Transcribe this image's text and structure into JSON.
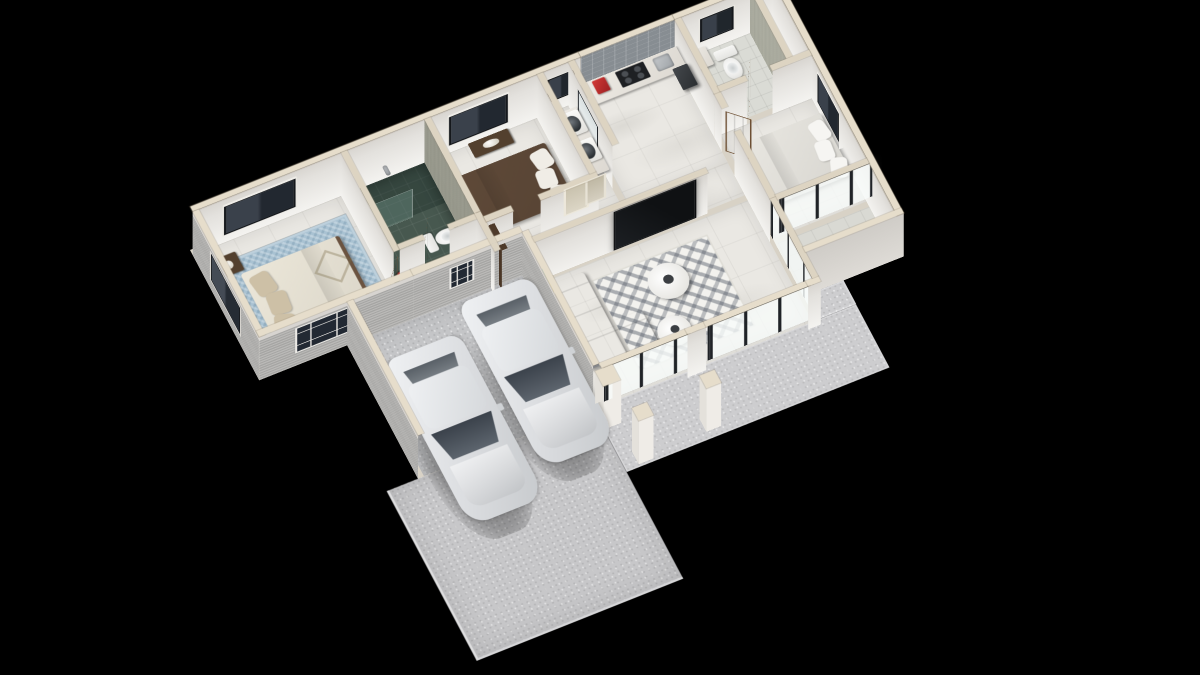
{
  "meta": {
    "title": "3D isometric floor plan render",
    "background": "#000000",
    "view": "axonometric dollhouse cutaway, single-storey house with carport and two cars"
  },
  "palette": {
    "wall_cap": "#e6ddcb",
    "wall_interior": "#f0eeea",
    "wall_exterior": "#b2b1af",
    "floor_marble": "#eae8e3",
    "bath_teal": "#47584f",
    "rug_blue": "#a9c2d2",
    "rug_pattern": "#f3f2ee",
    "sofa_grey": "#9c9ea1",
    "bed_brown": "#5e4938",
    "wood_door": "#97714c",
    "glass_frame": "#202327",
    "car_white": "#e6e8ea",
    "concrete": "#c6c6c8",
    "accent_red": "#c0282a",
    "art_teal": "#35a3ad",
    "art_sand": "#e3c765"
  },
  "scene": {
    "pxm": 56,
    "wallH": 106,
    "doorH": 98,
    "camera": {
      "originX": 190,
      "originY": 250,
      "scale": 0.82,
      "tiltDeg": 30,
      "spinDeg": -24.7
    },
    "base": [
      {
        "n": "house-base-back",
        "r": [
          0,
          0,
          14.05,
          3.6
        ]
      },
      {
        "n": "house-base-mid",
        "r": [
          2.1,
          3.6,
          9.6,
          3.85
        ]
      },
      {
        "n": "house-base-wing",
        "r": [
          11.55,
          2.05,
          2.5,
          4.6
        ]
      }
    ],
    "floors": [
      {
        "n": "bedroom1-floor",
        "s": "marble",
        "r": [
          0.15,
          0.15,
          3.4,
          3.3
        ]
      },
      {
        "n": "bedroom1-blue-rug",
        "s": "bluerug",
        "r": [
          0.5,
          0.6,
          2.95,
          2.55
        ],
        "z": 1.2
      },
      {
        "n": "bath1-floor",
        "s": "teal",
        "r": [
          3.7,
          0.15,
          1.85,
          2.6
        ]
      },
      {
        "n": "bath1-shower-zone",
        "s": "tealdark",
        "r": [
          3.7,
          0.15,
          1.85,
          1.1
        ],
        "z": 0.9
      },
      {
        "n": "hall-nook-floor",
        "s": "marble",
        "r": [
          3.7,
          2.9,
          1.85,
          0.9
        ]
      },
      {
        "n": "bedroom2-floor",
        "s": "marble",
        "r": [
          5.7,
          0.15,
          2.55,
          2.75
        ]
      },
      {
        "n": "laundry-floor",
        "s": "marble",
        "r": [
          8.4,
          0.15,
          0.6,
          2.75
        ]
      },
      {
        "n": "kitchen-floor",
        "s": "marble",
        "r": [
          9.15,
          0.15,
          2.4,
          2.75
        ]
      },
      {
        "n": "bath2-floor",
        "s": "tilelight",
        "r": [
          11.7,
          0.15,
          1.65,
          1.9
        ]
      },
      {
        "n": "closet-floor",
        "s": "marble",
        "r": [
          13.5,
          0.15,
          0.4,
          1.9
        ]
      },
      {
        "n": "corridor-floor-a",
        "s": "marble",
        "r": [
          5.7,
          2.9,
          0.6,
          0.55
        ]
      },
      {
        "n": "corridor-floor-b",
        "s": "marble",
        "r": [
          6.3,
          2.9,
          5.25,
          0.9
        ]
      },
      {
        "n": "bedroom3-floor",
        "s": "marble",
        "r": [
          11.7,
          2.2,
          2.2,
          2.85
        ]
      },
      {
        "n": "terrace-floor",
        "s": "terrazzo",
        "r": [
          11.7,
          5.2,
          2.2,
          1.3
        ]
      },
      {
        "n": "living-room-floor",
        "s": "marble",
        "r": [
          6.45,
          3.95,
          5.1,
          3.35
        ]
      },
      {
        "n": "living-triangle-rug",
        "s": "rugtri",
        "r": [
          7.6,
          4.35,
          2.8,
          2.55
        ],
        "z": 1.2
      },
      {
        "n": "garage-floor",
        "s": "concrete",
        "r": [
          2.25,
          3.6,
          4.05,
          3.7
        ]
      },
      {
        "n": "porch-slab",
        "s": "porch",
        "r": [
          6.3,
          7.3,
          6.3,
          1.75
        ],
        "z": 0.4
      },
      {
        "n": "porch-slab-2",
        "s": "porch",
        "r": [
          11.7,
          6.65,
          0.9,
          0.65
        ],
        "z": 0.4
      },
      {
        "n": "driveway-slab",
        "s": "drive",
        "r": [
          1.35,
          7.3,
          4.95,
          4.7
        ],
        "z": 0.3
      }
    ],
    "walls": [
      {
        "n": "back-wall-left",
        "d": "h",
        "x": 0,
        "y": 0,
        "len": 9.3,
        "th": 0.15,
        "cap": "ext",
        "face": "intwhite",
        "win": [
          {
            "t": "dark2",
            "off": 0.75,
            "w": 1.6
          },
          {
            "t": "dark2",
            "off": 6.15,
            "w": 1.3
          },
          {
            "t": "small2",
            "off": 8.5,
            "w": 0.55
          }
        ]
      },
      {
        "n": "back-wall-kitchen-tile",
        "d": "h",
        "x": 9.3,
        "y": 0,
        "len": 2.25,
        "th": 0.15,
        "cap": "ext",
        "face": "tile"
      },
      {
        "n": "back-wall-right",
        "d": "h",
        "x": 11.55,
        "y": 0,
        "len": 2.5,
        "th": 0.15,
        "cap": "ext",
        "face": "intwhite",
        "win": [
          {
            "t": "small2",
            "off": 0.6,
            "w": 0.7
          }
        ]
      },
      {
        "n": "left-gable-wall",
        "d": "v",
        "x": 0,
        "y": 0.15,
        "len": 3.45,
        "th": 0.15,
        "cap": "ext",
        "face": "extgrey",
        "win": [
          {
            "t": "extdark",
            "off": 0.95,
            "w": 1.4
          }
        ]
      },
      {
        "n": "front-wall-bedroom1",
        "d": "h",
        "x": 0,
        "y": 3.45,
        "len": 3.7,
        "th": 0.15,
        "cap": "ext",
        "face": "extgrey",
        "win": [
          {
            "t": "white4",
            "off": 0.85,
            "w": 1.25
          }
        ]
      },
      {
        "n": "garage-back-wall",
        "d": "h",
        "x": 3.7,
        "y": 3.45,
        "len": 2.6,
        "th": 0.15,
        "cap": "ext",
        "face": "extgrey",
        "win": [
          {
            "t": "white4s",
            "off": 0.85,
            "w": 0.5
          }
        ]
      },
      {
        "n": "garage-left-wall",
        "d": "v",
        "x": 2.1,
        "y": 3.6,
        "len": 3.7,
        "th": 0.15,
        "cap": "ext",
        "face": "extgrey"
      },
      {
        "n": "garage-right-wall",
        "d": "v",
        "x": 6.3,
        "y": 3.6,
        "len": 3.7,
        "th": 0.15,
        "cap": "ext",
        "face": "extgrey"
      },
      {
        "n": "front-glass-wall-a",
        "d": "h",
        "x": 6.45,
        "y": 7.3,
        "len": 2.05,
        "th": 0.15,
        "cap": "ext",
        "face": "glass",
        "win": [
          {
            "t": "glassdoor",
            "off": 0.04,
            "w": 1.97
          }
        ]
      },
      {
        "n": "front-pier",
        "d": "h",
        "x": 8.5,
        "y": 7.3,
        "len": 0.45,
        "th": 0.15,
        "cap": "ext",
        "face": "intwhite"
      },
      {
        "n": "front-glass-wall-b",
        "d": "h",
        "x": 8.95,
        "y": 7.3,
        "len": 2.45,
        "th": 0.15,
        "cap": "ext",
        "face": "glass",
        "win": [
          {
            "t": "glassdoor",
            "off": 0.04,
            "w": 2.37
          }
        ]
      },
      {
        "n": "front-corner-stub",
        "d": "h",
        "x": 11.4,
        "y": 7.3,
        "len": 0.3,
        "th": 0.15,
        "cap": "ext",
        "face": "intwhite"
      },
      {
        "n": "bedroom3-wall-a",
        "d": "v",
        "x": 11.55,
        "y": 2.2,
        "len": 0.4,
        "th": 0.15,
        "cap": "int",
        "face": "intwhite"
      },
      {
        "n": "bedroom3-wall-b",
        "d": "v",
        "x": 11.55,
        "y": 3.25,
        "len": 1.85,
        "th": 0.15,
        "cap": "int",
        "face": "intwhite"
      },
      {
        "n": "living-glass-wall",
        "d": "v",
        "x": 11.55,
        "y": 5.1,
        "len": 2.2,
        "th": 0.15,
        "cap": "int",
        "face": "glass",
        "win": [
          {
            "t": "glassdoor",
            "off": 0.04,
            "w": 2.12
          }
        ]
      },
      {
        "n": "wing-right-wall",
        "d": "v",
        "x": 13.9,
        "y": 0.15,
        "len": 6.5,
        "th": 0.15,
        "cap": "ext",
        "face": "intwhite",
        "win": [
          {
            "t": "dark2",
            "off": 2.35,
            "w": 1.0
          }
        ]
      },
      {
        "n": "terrace-front-wall",
        "d": "h",
        "x": 11.7,
        "y": 6.5,
        "len": 2.35,
        "th": 0.15,
        "cap": "ext",
        "face": "extlight"
      },
      {
        "n": "terrace-glass-slider",
        "d": "h",
        "x": 11.7,
        "y": 5.05,
        "len": 2.2,
        "th": 0.15,
        "cap": "int",
        "face": "glass",
        "win": [
          {
            "t": "glassdoor",
            "off": 0.04,
            "w": 2.12
          }
        ]
      },
      {
        "n": "bedroom1-bath1-wall",
        "d": "v",
        "x": 3.55,
        "y": 0.15,
        "len": 2.75,
        "th": 0.15,
        "cap": "int",
        "face": "intwhite"
      },
      {
        "n": "bath1-front-wall-a",
        "d": "h",
        "x": 3.7,
        "y": 2.75,
        "len": 0.6,
        "th": 0.15,
        "cap": "int",
        "face": "intwhite"
      },
      {
        "n": "bath1-front-wall-b",
        "d": "h",
        "x": 4.9,
        "y": 2.75,
        "len": 0.65,
        "th": 0.15,
        "cap": "int",
        "face": "intwhite"
      },
      {
        "n": "bath1-bedroom2-wall",
        "d": "v",
        "x": 5.55,
        "y": 0.15,
        "len": 2.6,
        "th": 0.15,
        "cap": "int",
        "face": "texsage"
      },
      {
        "n": "nook-bedroom2-wall",
        "d": "v",
        "x": 5.55,
        "y": 2.75,
        "len": 1.05,
        "th": 0.15,
        "cap": "int",
        "face": "intwhite"
      },
      {
        "n": "bedroom2-front-wall-a",
        "d": "h",
        "x": 5.7,
        "y": 2.9,
        "len": 0.65,
        "th": 0.15,
        "cap": "int",
        "face": "intwhite"
      },
      {
        "n": "bedroom2-front-wall-b",
        "d": "h",
        "x": 7.0,
        "y": 2.9,
        "len": 1.4,
        "th": 0.15,
        "cap": "int",
        "face": "intwhite",
        "win": [
          {
            "t": "artpale",
            "off": 0.55,
            "w": 0.5
          },
          {
            "t": "artpale2",
            "off": 1.08,
            "w": 0.38
          }
        ]
      },
      {
        "n": "bedroom2-laundry-wall",
        "d": "v",
        "x": 8.25,
        "y": 0.15,
        "len": 2.75,
        "th": 0.15,
        "cap": "int",
        "face": "intwhite"
      },
      {
        "n": "laundry-kitchen-wall",
        "d": "v",
        "x": 9.0,
        "y": 0.15,
        "len": 2.3,
        "th": 0.15,
        "cap": "int",
        "face": "intwhite",
        "win": [
          {
            "t": "inwin",
            "off": 0.5,
            "w": 0.95
          }
        ]
      },
      {
        "n": "kitchen-bath2-wall",
        "d": "v",
        "x": 11.55,
        "y": 0.15,
        "len": 2.05,
        "th": 0.15,
        "cap": "int",
        "face": "intwhite"
      },
      {
        "n": "bath2-closet-wall",
        "d": "v",
        "x": 13.35,
        "y": 0.15,
        "len": 1.9,
        "th": 0.15,
        "cap": "int",
        "face": "texsagelight"
      },
      {
        "n": "bath2-front-wall-a",
        "d": "h",
        "x": 11.7,
        "y": 2.05,
        "len": 0.65,
        "th": 0.15,
        "cap": "int",
        "face": "intwhite"
      },
      {
        "n": "bath2-front-wall-b",
        "d": "h",
        "x": 12.95,
        "y": 2.05,
        "len": 0.95,
        "th": 0.15,
        "cap": "int",
        "face": "intwhite"
      },
      {
        "n": "corridor-living-wall",
        "d": "h",
        "x": 6.45,
        "y": 3.8,
        "len": 4.15,
        "th": 0.15,
        "cap": "int",
        "face": "intwhite",
        "win": [
          {
            "t": "tv",
            "off": 1.9,
            "w": 1.9
          }
        ]
      },
      {
        "n": "shower-glass-screen",
        "d": "h",
        "x": 3.7,
        "y": 1.25,
        "len": 1.05,
        "th": 0.04,
        "cap": false,
        "face": "glassy",
        "h": 70
      },
      {
        "n": "hall-wardrobe",
        "d": "v",
        "x": 5.75,
        "y": 2.95,
        "len": 0.8,
        "th": 0.14,
        "cap": "wood",
        "face": "wooddark",
        "h": 96
      },
      {
        "n": "living-wall-art",
        "d": "v",
        "x": 6.52,
        "y": 4.05,
        "len": 0.8,
        "th": 0.04,
        "cap": false,
        "face": "art",
        "h": 58,
        "lift": 28
      }
    ],
    "doors": [
      {
        "n": "bedroom1-door",
        "hx": 3.62,
        "hy": 2.95,
        "len": 0.62,
        "ang": 130
      },
      {
        "n": "bath1-door",
        "hx": 4.35,
        "hy": 2.8,
        "len": 0.58,
        "ang": -60
      },
      {
        "n": "bedroom2-door",
        "hx": 6.4,
        "hy": 2.97,
        "len": 0.62,
        "ang": -65
      },
      {
        "n": "bath2-door",
        "hx": 12.4,
        "hy": 2.12,
        "len": 0.58,
        "ang": -60
      },
      {
        "n": "bedroom3-door",
        "hx": 11.62,
        "hy": 2.62,
        "len": 0.6,
        "ang": 45
      }
    ],
    "columns": [
      {
        "n": "porch-pier",
        "x": 6.28,
        "y": 7.45,
        "s": 0.42
      },
      {
        "n": "porch-column-1",
        "x": 6.62,
        "y": 8.62,
        "s": 0.36
      },
      {
        "n": "porch-column-2",
        "x": 8.3,
        "y": 8.5,
        "s": 0.36
      }
    ],
    "items": [
      {
        "t": "bed",
        "n": "bed-bedroom1",
        "r": [
          0.7,
          1.1,
          2.35,
          1.9
        ],
        "head": "left",
        "duvet": "#ece7d9",
        "pillow": "#cdc0a6",
        "frame": "#6b5340",
        "accent": true
      },
      {
        "t": "bed",
        "n": "bed-bedroom2",
        "r": [
          6.0,
          0.85,
          2.1,
          1.6
        ],
        "head": "right",
        "duvet": "#5e4938",
        "pillow": "#f0ede6",
        "frame": "#44332a"
      },
      {
        "t": "bed",
        "n": "bed-bedroom3",
        "r": [
          12.0,
          2.7,
          1.85,
          1.7
        ],
        "head": "right",
        "duvet": "#e8e6e0",
        "pillow": "#f6f5f2",
        "frame": "#b9b5ac"
      },
      {
        "t": "box",
        "n": "nightstand-1",
        "r": [
          0.32,
          0.55,
          0.5,
          0.5
        ],
        "s": "nightstand",
        "z": 12
      },
      {
        "t": "box",
        "n": "nightstand-2",
        "r": [
          0.32,
          3.05,
          0.5,
          0.5
        ],
        "s": "nightstand",
        "z": 12
      },
      {
        "t": "disc",
        "n": "flower-vase-red",
        "c": [
          0.57,
          3.0,
          0.1
        ],
        "s": "flowers",
        "z": 16
      },
      {
        "t": "disc",
        "n": "hall-plant-red",
        "c": [
          3.88,
          2.62,
          0.12
        ],
        "s": "flowers",
        "z": 10
      },
      {
        "t": "box",
        "n": "dresser-bedroom2",
        "r": [
          6.55,
          0.22,
          0.95,
          0.38
        ],
        "s": "nightstand",
        "z": 12
      },
      {
        "t": "sofa",
        "n": "sofa-sectional",
        "r": [
          6.6,
          4.15,
          1.66,
          2.3
        ],
        "bw": 0.92,
        "ch": [
          0.92,
          1.4,
          0.74,
          0.9
        ]
      },
      {
        "t": "disc",
        "n": "coffee-table-1",
        "c": [
          9.1,
          5.15,
          0.46
        ],
        "s": "table",
        "z": 10
      },
      {
        "t": "disc",
        "n": "table-decor-1",
        "c": [
          9.1,
          5.15,
          0.12
        ],
        "s": "deco",
        "z": 14
      },
      {
        "t": "disc",
        "n": "coffee-table-2",
        "c": [
          8.7,
          6.35,
          0.38
        ],
        "s": "table",
        "z": 10
      },
      {
        "t": "disc",
        "n": "table-decor-2",
        "c": [
          8.7,
          6.35,
          0.1
        ],
        "s": "deco",
        "z": 14
      },
      {
        "t": "toilet",
        "n": "toilet-bath1",
        "c": [
          5.1,
          2.1
        ],
        "rot": -90
      },
      {
        "t": "toilet",
        "n": "toilet-bath2",
        "c": [
          12.62,
          0.75
        ],
        "rot": 0
      },
      {
        "t": "box",
        "n": "kitchen-counter",
        "r": [
          9.3,
          0.18,
          2.25,
          0.62
        ],
        "s": "counter",
        "z": 46
      },
      {
        "t": "box",
        "n": "cooktop-black",
        "r": [
          10.05,
          0.26,
          0.68,
          0.44
        ],
        "s": "cooktop",
        "z": 49
      },
      {
        "t": "box",
        "n": "kitchen-sink",
        "r": [
          10.92,
          0.3,
          0.4,
          0.36
        ],
        "s": "steel",
        "z": 49
      },
      {
        "t": "box",
        "n": "red-coffee-maker",
        "r": [
          9.5,
          0.26,
          0.3,
          0.36
        ],
        "s": "redapp",
        "z": 49
      },
      {
        "t": "box",
        "n": "fridge",
        "r": [
          11.16,
          0.85,
          0.36,
          0.6
        ],
        "s": "darkbox",
        "z": 64
      },
      {
        "t": "box",
        "n": "laundry-counter",
        "r": [
          8.45,
          0.62,
          0.52,
          1.75
        ],
        "s": "counter",
        "z": 42
      },
      {
        "t": "box",
        "n": "washer-1",
        "r": [
          8.47,
          0.72,
          0.48,
          0.6
        ],
        "s": "machine",
        "z": 45
      },
      {
        "t": "box",
        "n": "washer-2",
        "r": [
          8.47,
          1.48,
          0.48,
          0.6
        ],
        "s": "machine",
        "z": 45
      },
      {
        "t": "box",
        "n": "bath2-vanity",
        "r": [
          11.78,
          0.3,
          0.42,
          0.5
        ],
        "s": "counter",
        "z": 30
      },
      {
        "t": "box",
        "n": "shower-fixture",
        "r": [
          4.5,
          0.22,
          0.1,
          0.26
        ],
        "s": "steel",
        "z": 40
      },
      {
        "t": "car",
        "n": "car-1",
        "r": [
          2.45,
          4.75,
          1.8,
          4.55
        ]
      },
      {
        "t": "car",
        "n": "car-2",
        "r": [
          4.5,
          4.1,
          1.76,
          4.55
        ]
      }
    ]
  }
}
